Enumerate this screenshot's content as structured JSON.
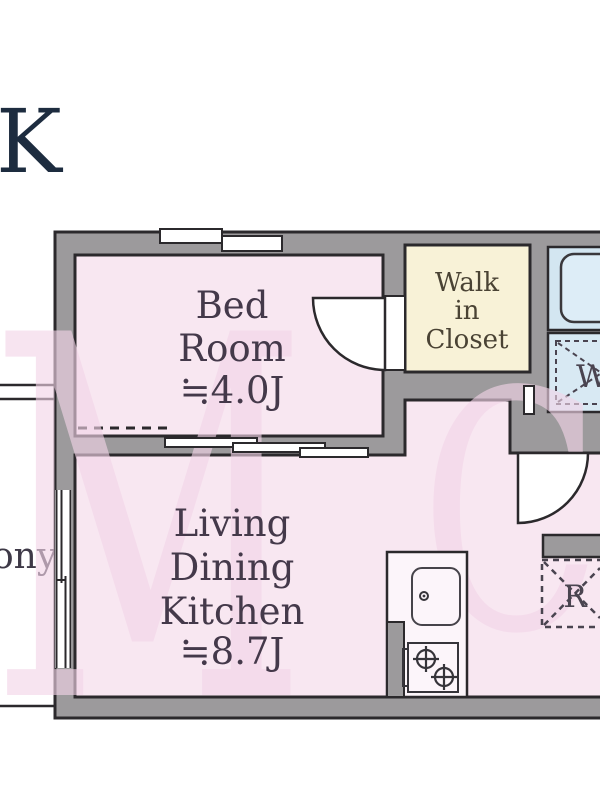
{
  "floor_plan": {
    "unit_type_partial": "K",
    "balcony_partial": "ony",
    "bedroom": {
      "line1": "Bed",
      "line2": "Room",
      "size": "≒4.0J"
    },
    "ldk": {
      "line1": "Living",
      "line2": "Dining",
      "line3": "Kitchen",
      "size": "≒8.7J"
    },
    "walk_in_closet": {
      "line1": "Walk",
      "line2": "in",
      "line3": "Closet"
    },
    "washing_machine_label": "W",
    "refrigerator_label": "R",
    "watermark": {
      "letter1": "M",
      "letter2": "C"
    },
    "colors": {
      "wall_gray": "#9c9a9c",
      "room_pink": "#f8e7f1",
      "closet_yellow": "#f8f2d7",
      "bath_blue": "#d3e6f1",
      "tub_blue": "#ddedf7",
      "counter_white": "#fcf5fa",
      "outline_black": "#2b292c",
      "label_dark": "#44394a",
      "type_navy": "#1d2c3f",
      "watermark_pink": "#f3d5e8"
    }
  }
}
